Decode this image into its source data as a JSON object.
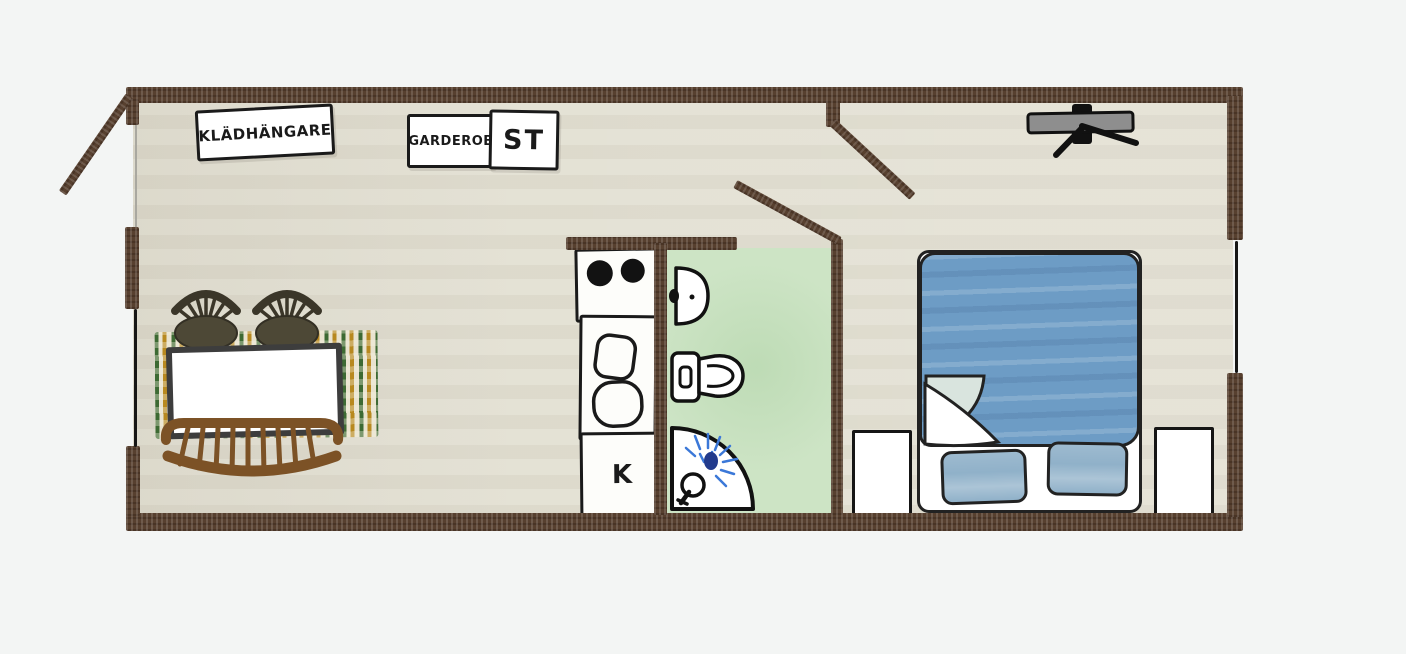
{
  "labels": {
    "coat_rack": "KLÄDHÄNGARE",
    "wardrobe": "GARDEROB",
    "storage": "ST",
    "kitchen": "K"
  },
  "colors": {
    "paper": "#f3f5f4",
    "floor": "#e3e0d3",
    "wall": "#57402f",
    "ink": "#1a1a1a",
    "window_line": "#161616",
    "bath_floor": "#cde4c5",
    "bed_blue": "#6d9cc5",
    "pillow_blue": "#90b1c9",
    "fold_underside": "#d9e4de",
    "rug_green": "#3d6a33",
    "rug_gold": "#b8891f",
    "rug_base": "#e9e3cf",
    "bench_brown": "#7c5226",
    "chair_olive": "#4d4836",
    "chair_dark": "#3b3629",
    "tv_gray": "#8e8e8e",
    "shower_spray_blue": "#3b78d8"
  }
}
